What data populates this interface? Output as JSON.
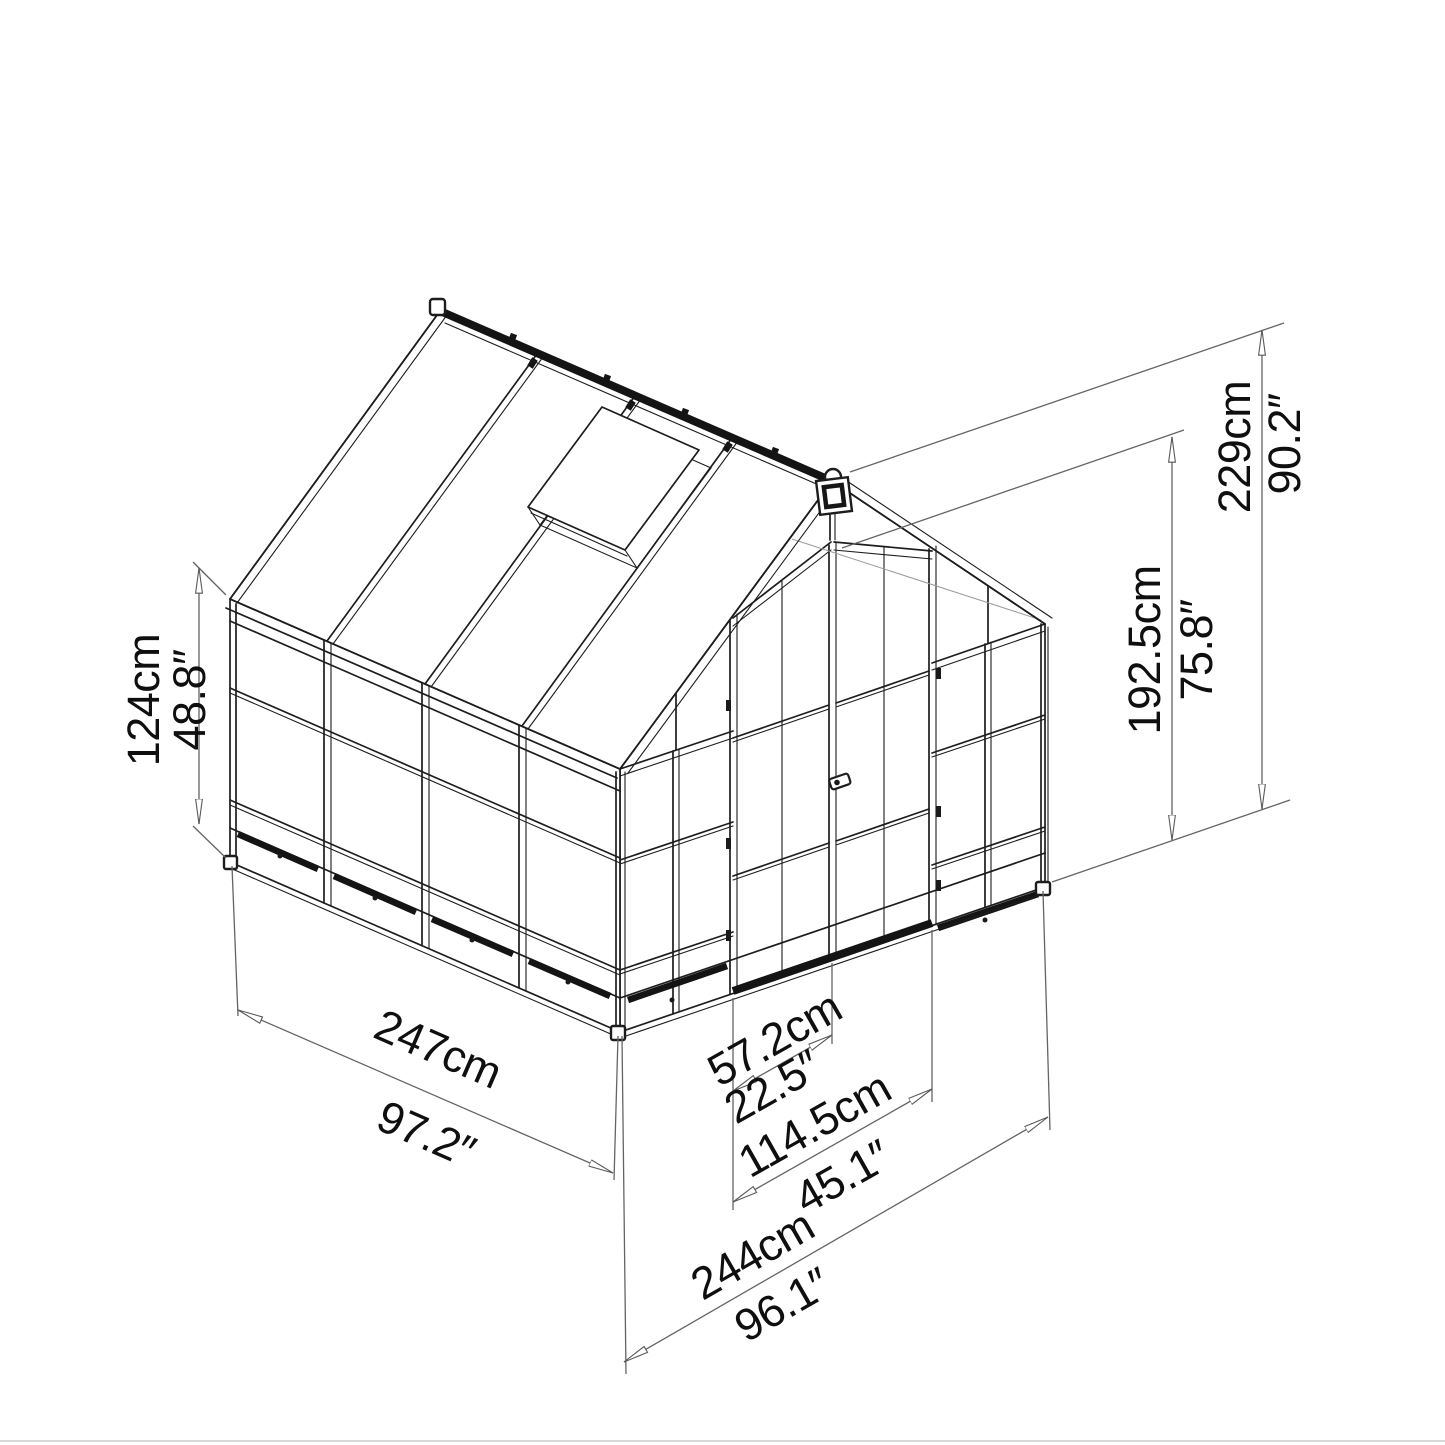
{
  "diagram": {
    "type": "greenhouse-dimension-drawing",
    "background": "#ffffff",
    "line_color": "#1d1d1d",
    "dimension_line_color": "#646464",
    "dimensions": {
      "side_wall_height": {
        "metric": "124cm",
        "imperial": "48.8″"
      },
      "ridge_height": {
        "metric": "229cm",
        "imperial": "90.2″"
      },
      "door_height": {
        "metric": "192.5cm",
        "imperial": "75.8″"
      },
      "depth": {
        "metric": "247cm",
        "imperial": "97.2″"
      },
      "width": {
        "metric": "244cm",
        "imperial": "96.1″"
      },
      "door_width": {
        "metric": "57.2cm",
        "imperial": "22.5″"
      },
      "double_door_width": {
        "metric": "114.5cm",
        "imperial": "45.1″"
      }
    }
  }
}
